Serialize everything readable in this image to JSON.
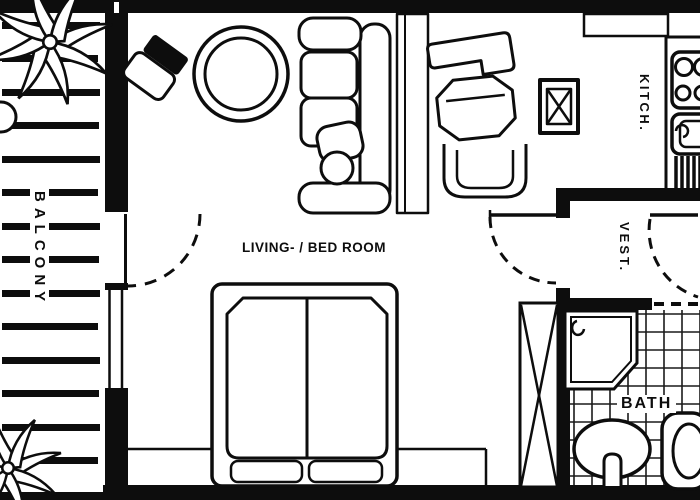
{
  "title": "Studio apartment floor plan (scanned blueprint)",
  "labels": {
    "living": "LIVING- / BED ROOM",
    "balcony": "BALCONY",
    "kitchen": "KITCH.",
    "vestibule": "VEST.",
    "bath": "BATH"
  },
  "palette": {
    "ink": "#0d0d0d",
    "paper": "#ffffff"
  },
  "furniture_icons": [
    "palm-plant",
    "plant-pot",
    "lounge-chair",
    "round-table",
    "sofa",
    "bookshelf",
    "writing-desk",
    "armchair",
    "tub-chair",
    "side-table",
    "double-bed",
    "kitchen-stove",
    "kitchen-sink",
    "dish-drainer",
    "closet",
    "shower-tray",
    "wash-basin",
    "toilet"
  ]
}
